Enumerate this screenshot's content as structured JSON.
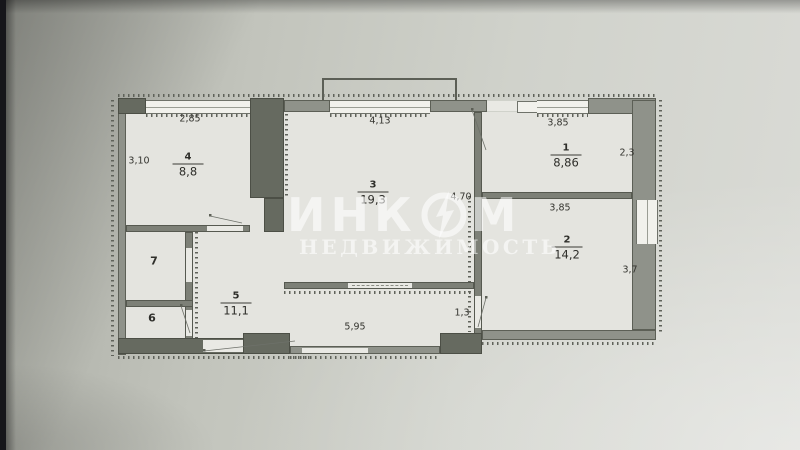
{
  "watermark": {
    "brand_prefix": "ИНК",
    "brand_suffix": "М",
    "subtitle": "НЕДВИЖИМОСТЬ"
  },
  "rooms": {
    "r1": {
      "number": "1",
      "area": "8,86"
    },
    "r2": {
      "number": "2",
      "area": "14,2"
    },
    "r3": {
      "number": "3",
      "area": "19,3"
    },
    "r4": {
      "number": "4",
      "area": "8,8"
    },
    "r5": {
      "number": "5",
      "area": "11,1"
    },
    "r6": {
      "number": "6"
    },
    "r7": {
      "number": "7"
    }
  },
  "dimensions": {
    "room4_top": "2,85",
    "room4_left": "3,10",
    "room3_top": "4,13",
    "room3_right": "4,70",
    "room1_top": "3,85",
    "room1_right": "2,3",
    "room2_top": "3,85",
    "room2_right": "3,7",
    "hall_bottom": "5,95",
    "hall_right": "1,3"
  },
  "colors": {
    "paper": "#cfd1ca",
    "wall": "#8f928a",
    "wall_dark": "#666a60",
    "line": "#4f524a",
    "watermark_text": "#ffffff"
  }
}
